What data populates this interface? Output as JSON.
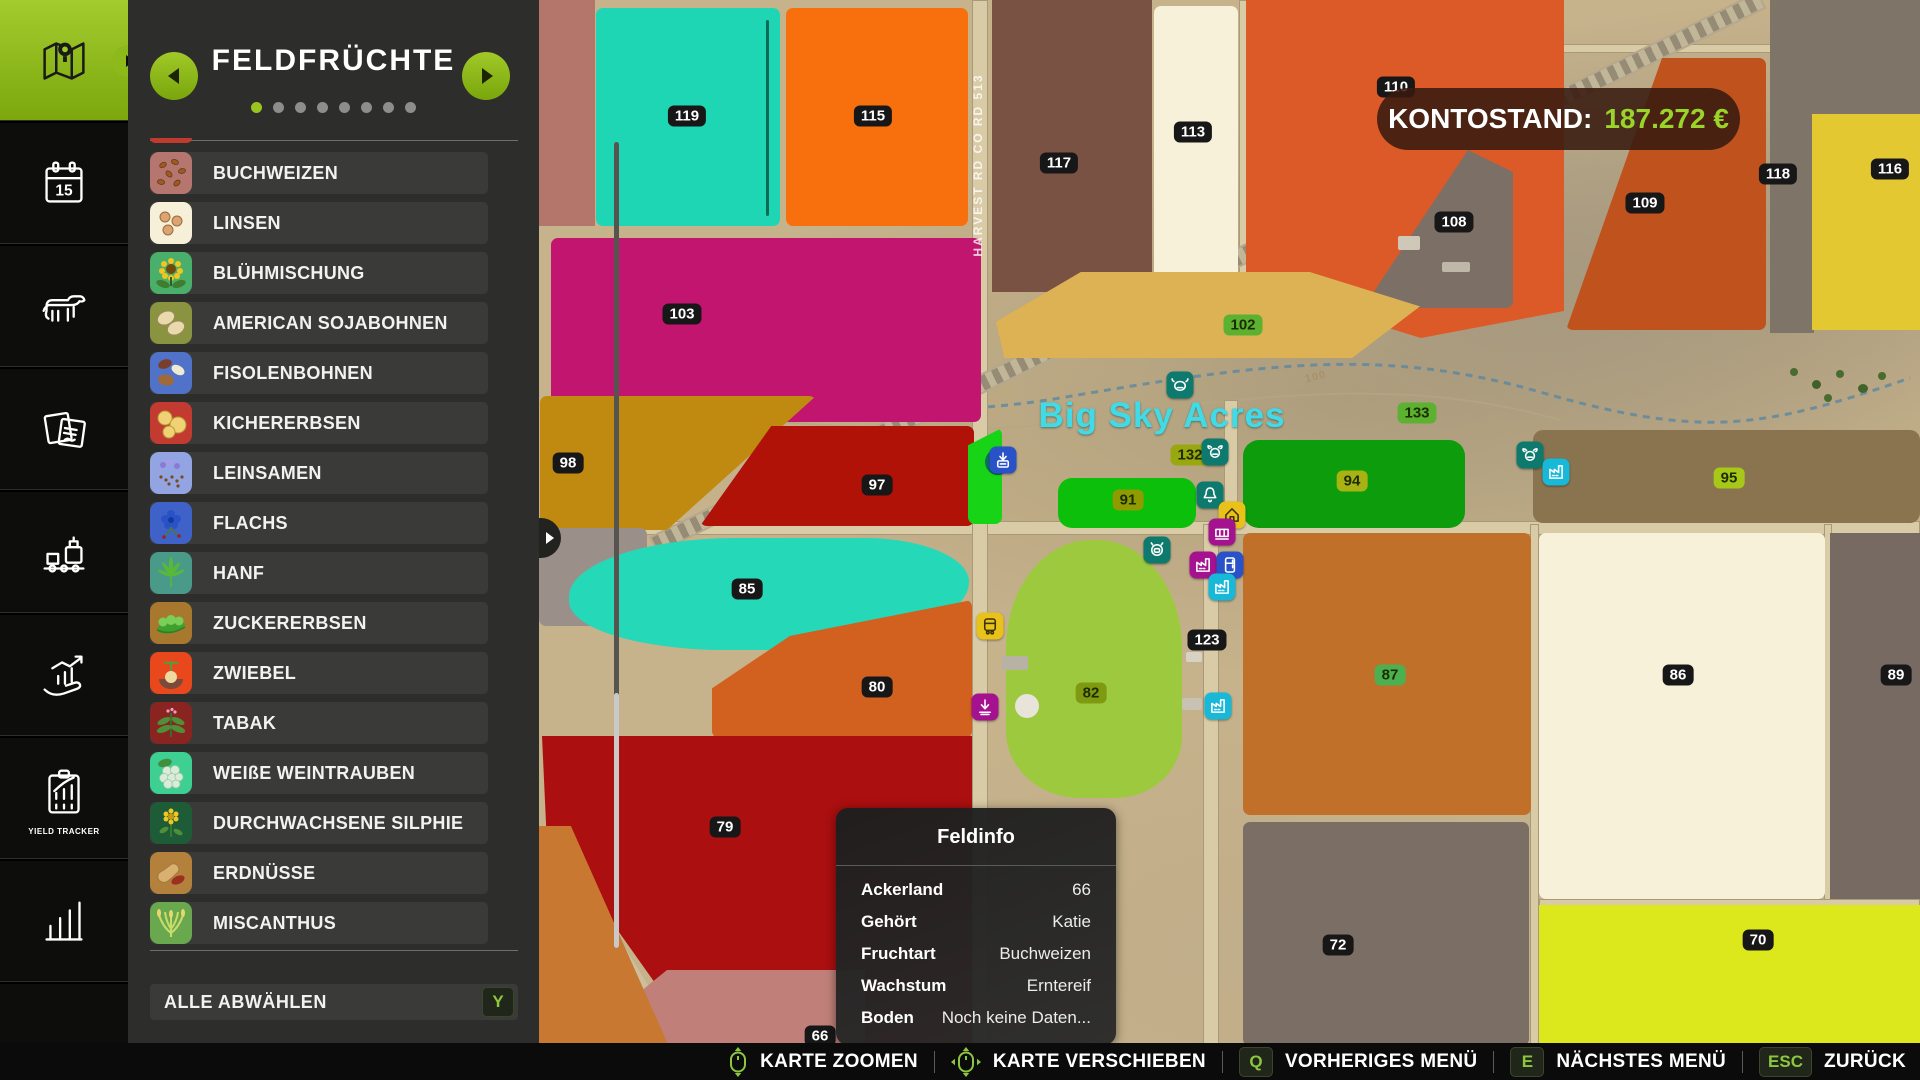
{
  "sidebar": {
    "active_index": 0,
    "items": [
      {
        "icon": "map-icon",
        "label": ""
      },
      {
        "icon": "calendar-icon",
        "label": "",
        "day": "15"
      },
      {
        "icon": "animals-icon",
        "label": ""
      },
      {
        "icon": "contracts-icon",
        "label": ""
      },
      {
        "icon": "production-icon",
        "label": ""
      },
      {
        "icon": "finance-icon",
        "label": ""
      },
      {
        "icon": "yield-tracker-icon",
        "label": "YIELD TRACKER"
      },
      {
        "icon": "prices-icon",
        "label": ""
      },
      {
        "icon": "partial-icon",
        "label": ""
      }
    ]
  },
  "panel": {
    "title": "FELDFRÜCHTE",
    "dots_total": 8,
    "dots_active": 0,
    "deselect": {
      "label": "ALLE ABWÄHLEN",
      "key": "Y"
    },
    "crops": [
      {
        "label": "BUCHWEIZEN",
        "tile_color": "#b4766e",
        "glyph": "buchweizen"
      },
      {
        "label": "LINSEN",
        "tile_color": "#f7f0d8",
        "glyph": "linsen"
      },
      {
        "label": "BLÜHMISCHUNG",
        "tile_color": "#4aaf6b",
        "glyph": "bluehmischung"
      },
      {
        "label": "AMERICAN SOJABOHNEN",
        "tile_color": "#8a9440",
        "glyph": "sojabohnen"
      },
      {
        "label": "FISOLENBOHNEN",
        "tile_color": "#5072c8",
        "glyph": "fisolenbohnen"
      },
      {
        "label": "KICHERERBSEN",
        "tile_color": "#c23a30",
        "glyph": "kichererbsen"
      },
      {
        "label": "LEINSAMEN",
        "tile_color": "#92a5e2",
        "glyph": "leinsamen"
      },
      {
        "label": "FLACHS",
        "tile_color": "#3f62c8",
        "glyph": "flachs"
      },
      {
        "label": "HANF",
        "tile_color": "#4a9a8a",
        "glyph": "hanf"
      },
      {
        "label": "ZUCKERERBSEN",
        "tile_color": "#a9782f",
        "glyph": "zuckererbsen"
      },
      {
        "label": "ZWIEBEL",
        "tile_color": "#e8481c",
        "glyph": "zwiebel"
      },
      {
        "label": "TABAK",
        "tile_color": "#8a2420",
        "glyph": "tabak"
      },
      {
        "label": "WEIßE WEINTRAUBEN",
        "tile_color": "#3ecf92",
        "glyph": "weintrauben"
      },
      {
        "label": "DURCHWACHSENE SILPHIE",
        "tile_color": "#1e5c38",
        "glyph": "silphie"
      },
      {
        "label": "ERDNÜSSE",
        "tile_color": "#b3813c",
        "glyph": "erdnuesse"
      },
      {
        "label": "MISCANTHUS",
        "tile_color": "#6aa84f",
        "glyph": "miscanthus"
      }
    ]
  },
  "balance": {
    "label": "KONTOSTAND:",
    "amount": "187.272 €",
    "amount_color": "#9ad32a"
  },
  "feldinfo": {
    "title": "Feldinfo",
    "rows": [
      {
        "label": "Ackerland",
        "value": "66"
      },
      {
        "label": "Gehört",
        "value": "Katie"
      },
      {
        "label": "Fruchtart",
        "value": "Buchweizen"
      },
      {
        "label": "Wachstum",
        "value": "Erntereif"
      },
      {
        "label": "Boden",
        "value": "Noch keine Daten..."
      }
    ]
  },
  "map": {
    "title_overlay": "Big Sky Acres",
    "road_label": "HARVEST RD CO RD 513",
    "contour_label": "100",
    "fields": [
      {
        "x": 539,
        "y": 0,
        "w": 56,
        "h": 226,
        "color": "#b4766b",
        "r": 0
      },
      {
        "x": 596,
        "y": 8,
        "w": 184,
        "h": 218,
        "color": "#1fd6b4"
      },
      {
        "x": 786,
        "y": 8,
        "w": 182,
        "h": 218,
        "color": "#f8700e"
      },
      {
        "x": 992,
        "y": 0,
        "w": 160,
        "h": 292,
        "color": "#7a5243",
        "r": 0
      },
      {
        "x": 1154,
        "y": 6,
        "w": 84,
        "h": 278,
        "color": "#f7f1d9"
      },
      {
        "x": 1246,
        "y": 0,
        "w": 318,
        "h": 338,
        "color": "#dc5a28",
        "r": 0,
        "clip": "polygon(0 0,100% 0,100% 92%,55% 100%,0 84%)"
      },
      {
        "x": 1363,
        "y": 150,
        "w": 150,
        "h": 158,
        "color": "#7c6f66",
        "clip": "polygon(70% 0,100% 14%,100% 100%,0 100%)"
      },
      {
        "x": 1566,
        "y": 58,
        "w": 200,
        "h": 272,
        "color": "#c0531d",
        "clip": "polygon(48% 0,100% 0,100% 100%,0 100%)"
      },
      {
        "x": 1770,
        "y": 0,
        "w": 150,
        "h": 115,
        "color": "#7f7468",
        "r": 0
      },
      {
        "x": 1770,
        "y": 115,
        "w": 44,
        "h": 218,
        "color": "#7f7468",
        "r": 0
      },
      {
        "x": 1812,
        "y": 114,
        "w": 108,
        "h": 216,
        "color": "#e3c832",
        "r": 0
      },
      {
        "x": 551,
        "y": 238,
        "w": 430,
        "h": 184,
        "color": "#c21570"
      },
      {
        "x": 996,
        "y": 272,
        "w": 424,
        "h": 86,
        "color": "#dcb254",
        "clip": "polygon(0 58%,20% 0,74% 0,100% 40%,84% 100%,2% 100%)"
      },
      {
        "x": 540,
        "y": 396,
        "w": 276,
        "h": 134,
        "color": "#c08a10",
        "clip": "polygon(0 0,100% 0,46% 100%,0 100%)"
      },
      {
        "x": 700,
        "y": 426,
        "w": 274,
        "h": 100,
        "color": "#b01208",
        "clip": "polygon(26% 0,100% 0,100% 100%,0 100%)"
      },
      {
        "x": 968,
        "y": 428,
        "w": 34,
        "h": 96,
        "color": "#17d417",
        "clip": "polygon(0 18%,100% 0,100% 100%,0 100%)"
      },
      {
        "x": 1058,
        "y": 478,
        "w": 138,
        "h": 50,
        "color": "#0bbf0b",
        "r": 14
      },
      {
        "x": 1243,
        "y": 440,
        "w": 222,
        "h": 88,
        "color": "#0c9c0c",
        "r": 16
      },
      {
        "x": 1533,
        "y": 430,
        "w": 387,
        "h": 93,
        "color": "#8a7450",
        "r": 10
      },
      {
        "x": 539,
        "y": 528,
        "w": 108,
        "h": 98,
        "color": "#9b9089"
      },
      {
        "x": 569,
        "y": 538,
        "w": 400,
        "h": 112,
        "color": "#25d8b8",
        "radius": "48% 30% 55% 45% / 60% 45% 70% 50%"
      },
      {
        "x": 712,
        "y": 600,
        "w": 260,
        "h": 138,
        "color": "#d2601e",
        "clip": "polygon(0 64%,30% 26%,100% 0,100% 100%,0 100%)"
      },
      {
        "x": 542,
        "y": 736,
        "w": 430,
        "h": 312,
        "color": "#ab0f0f",
        "clip": "polygon(0 0,100% 0,100% 100%,37% 100%,1% 30%)",
        "r": 0
      },
      {
        "x": 640,
        "y": 970,
        "w": 225,
        "h": 78,
        "color": "#c08079",
        "clip": "polygon(12% 0,100% 0,100% 100%,0 100%,0 28%)",
        "r": 0
      },
      {
        "x": 539,
        "y": 826,
        "w": 145,
        "h": 254,
        "color": "#c87830",
        "clip": "polygon(0 0,22% 0,100% 100%,0 100%)",
        "r": 0
      },
      {
        "x": 1006,
        "y": 540,
        "w": 176,
        "h": 258,
        "color": "#9dc93f",
        "radius": "48% 48% 38% 42% / 42% 42% 24% 26%"
      },
      {
        "x": 1243,
        "y": 533,
        "w": 288,
        "h": 282,
        "color": "#c1702a"
      },
      {
        "x": 1539,
        "y": 533,
        "w": 286,
        "h": 366,
        "color": "#f7f1d9"
      },
      {
        "x": 1830,
        "y": 533,
        "w": 90,
        "h": 366,
        "color": "#766a62",
        "r": 0
      },
      {
        "x": 1243,
        "y": 822,
        "w": 286,
        "h": 224,
        "color": "#7b6f65"
      },
      {
        "x": 1539,
        "y": 905,
        "w": 381,
        "h": 143,
        "color": "#dde81c",
        "r": 0
      }
    ],
    "badges": [
      {
        "label": "119",
        "x": 687,
        "y": 116,
        "bg": "dark"
      },
      {
        "label": "115",
        "x": 873,
        "y": 116,
        "bg": "dark"
      },
      {
        "label": "113",
        "x": 1193,
        "y": 132,
        "bg": "dark"
      },
      {
        "label": "117",
        "x": 1059,
        "y": 163,
        "bg": "dark"
      },
      {
        "label": "110",
        "x": 1396,
        "y": 87,
        "bg": "dark"
      },
      {
        "label": "118",
        "x": 1778,
        "y": 174,
        "bg": "dark"
      },
      {
        "label": "116",
        "x": 1890,
        "y": 169,
        "bg": "dark"
      },
      {
        "label": "109",
        "x": 1645,
        "y": 203,
        "bg": "dark"
      },
      {
        "label": "108",
        "x": 1454,
        "y": 222,
        "bg": "dark"
      },
      {
        "label": "103",
        "x": 682,
        "y": 314,
        "bg": "dark"
      },
      {
        "label": "102",
        "x": 1243,
        "y": 325,
        "bg": "#5cb130"
      },
      {
        "label": "133",
        "x": 1417,
        "y": 413,
        "bg": "#5cb130"
      },
      {
        "label": "98",
        "x": 568,
        "y": 463,
        "bg": "dark"
      },
      {
        "label": "97",
        "x": 877,
        "y": 485,
        "bg": "dark"
      },
      {
        "label": "132",
        "x": 1190,
        "y": 455,
        "bg": "#9aa80f"
      },
      {
        "label": "91",
        "x": 1128,
        "y": 500,
        "bg": "#8f9b00"
      },
      {
        "label": "94",
        "x": 1352,
        "y": 481,
        "bg": "#a8b212"
      },
      {
        "label": "95",
        "x": 1729,
        "y": 478,
        "bg": "#a7c818"
      },
      {
        "label": "85",
        "x": 747,
        "y": 589,
        "bg": "dark"
      },
      {
        "label": "80",
        "x": 877,
        "y": 687,
        "bg": "dark"
      },
      {
        "label": "123",
        "x": 1207,
        "y": 640,
        "bg": "dark"
      },
      {
        "label": "87",
        "x": 1390,
        "y": 675,
        "bg": "#4caf50"
      },
      {
        "label": "86",
        "x": 1678,
        "y": 675,
        "bg": "dark"
      },
      {
        "label": "89",
        "x": 1896,
        "y": 675,
        "bg": "dark"
      },
      {
        "label": "82",
        "x": 1091,
        "y": 693,
        "bg": "#7f9a10"
      },
      {
        "label": "79",
        "x": 725,
        "y": 827,
        "bg": "dark"
      },
      {
        "label": "72",
        "x": 1338,
        "y": 945,
        "bg": "dark"
      },
      {
        "label": "70",
        "x": 1758,
        "y": 940,
        "bg": "dark"
      },
      {
        "label": "66",
        "x": 820,
        "y": 1036,
        "bg": "dark"
      }
    ],
    "icons": [
      {
        "x": 1180,
        "y": 385,
        "color": "#0e7a6e",
        "glyph": "bison-icon"
      },
      {
        "x": 1003,
        "y": 460,
        "color": "#2a52c8",
        "glyph": "download-icon"
      },
      {
        "x": 1215,
        "y": 452,
        "color": "#0e7a6e",
        "glyph": "cow-icon"
      },
      {
        "x": 1210,
        "y": 495,
        "color": "#0e7a6e",
        "glyph": "bell-icon"
      },
      {
        "x": 1232,
        "y": 515,
        "color": "#e8c21a",
        "glyph": "house-icon"
      },
      {
        "x": 1222,
        "y": 532,
        "color": "#a5128f",
        "glyph": "pallet-icon"
      },
      {
        "x": 1157,
        "y": 550,
        "color": "#0e7a6e",
        "glyph": "pig-icon"
      },
      {
        "x": 1203,
        "y": 565,
        "color": "#a5128f",
        "glyph": "factory-icon"
      },
      {
        "x": 1230,
        "y": 565,
        "color": "#2a52c8",
        "glyph": "fridge-icon"
      },
      {
        "x": 1222,
        "y": 587,
        "color": "#17b8d8",
        "glyph": "factory-icon"
      },
      {
        "x": 990,
        "y": 626,
        "color": "#e8c21a",
        "glyph": "train-icon"
      },
      {
        "x": 985,
        "y": 707,
        "color": "#a5128f",
        "glyph": "down-icon"
      },
      {
        "x": 1218,
        "y": 706,
        "color": "#17b8d8",
        "glyph": "factory-icon"
      },
      {
        "x": 1530,
        "y": 455,
        "color": "#0e7a6e",
        "glyph": "cow-icon"
      },
      {
        "x": 1556,
        "y": 472,
        "color": "#17b8d8",
        "glyph": "factory-icon"
      }
    ]
  },
  "bottombar": {
    "items": [
      {
        "type": "mouse",
        "icon": "mouse-zoom-icon",
        "label": "KARTE ZOOMEN"
      },
      {
        "type": "mouse",
        "icon": "mouse-move-icon",
        "label": "KARTE VERSCHIEBEN"
      },
      {
        "type": "key",
        "key": "Q",
        "label": "VORHERIGES MENÜ"
      },
      {
        "type": "key",
        "key": "E",
        "label": "NÄCHSTES MENÜ"
      },
      {
        "type": "key",
        "key": "ESC",
        "label": "ZURÜCK"
      }
    ]
  }
}
